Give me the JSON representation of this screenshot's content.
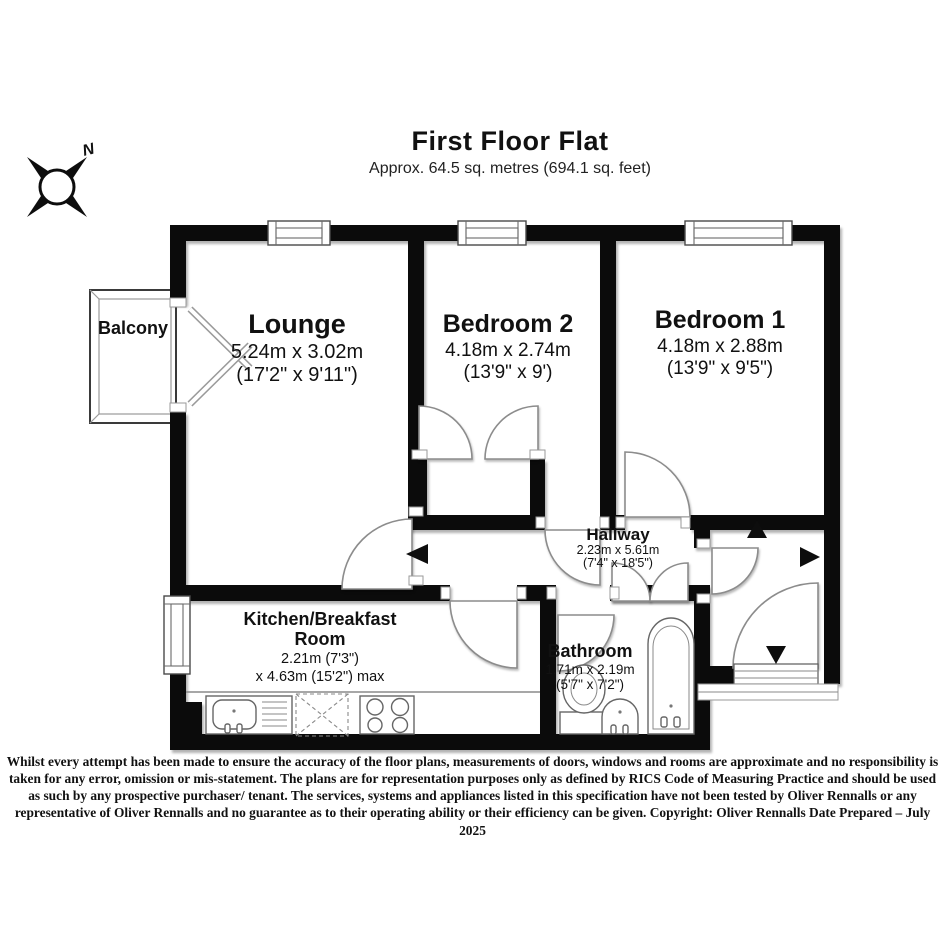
{
  "title": {
    "heading": "First Floor Flat",
    "subtitle": "Approx. 64.5 sq. metres (694.1 sq. feet)"
  },
  "compass": {
    "north_label": "N"
  },
  "rooms": {
    "lounge": {
      "name": "Lounge",
      "metric": "5.24m x 3.02m",
      "imperial": "(17'2\" x 9'11\")"
    },
    "bedroom2": {
      "name": "Bedroom 2",
      "metric": "4.18m x 2.74m",
      "imperial": "(13'9\" x 9')"
    },
    "bedroom1": {
      "name": "Bedroom 1",
      "metric": "4.18m x 2.88m",
      "imperial": "(13'9\" x 9'5\")"
    },
    "hallway": {
      "name": "Hallway",
      "metric": "2.23m x 5.61m",
      "imperial": "(7'4\" x 18'5\")"
    },
    "kitchen": {
      "name_line1": "Kitchen/Breakfast",
      "name_line2": "Room",
      "metric": "2.21m (7'3\")",
      "imperial": "x 4.63m (15'2\") max"
    },
    "bathroom": {
      "name": "Bathroom",
      "metric": "1.71m x 2.19m",
      "imperial": "(5'7\" x 7'2\")"
    },
    "balcony": {
      "name": "Balcony"
    }
  },
  "disclaimer": "Whilst every attempt has been made to ensure the accuracy of the floor plans, measurements of doors, windows and rooms are approximate and no responsibility is taken for any error, omission or mis-statement. The plans are for representation purposes only as defined by RICS Code of Measuring Practice and should be used as such by any prospective purchaser/ tenant. The services, systems and appliances listed in this specification have not been tested by Oliver Rennalls or any representative of Oliver Rennalls and no guarantee as to their operating ability or their efficiency can be given. Copyright: Oliver Rennalls Date Prepared – July 2025",
  "colors": {
    "wall": "#0b0b0b",
    "text": "#111111",
    "background": "#ffffff"
  }
}
